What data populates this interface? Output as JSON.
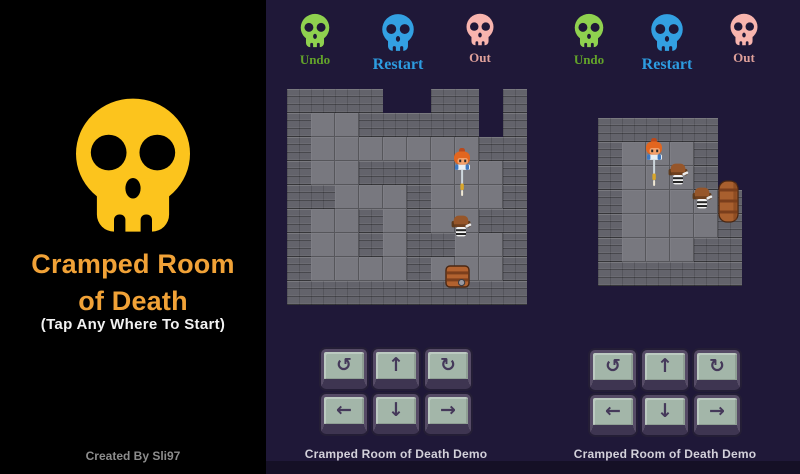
{
  "left_panel": {
    "title_line1": "Cramped Room",
    "title_line2": "of Death",
    "subtitle": "(Tap Any Where To Start)",
    "credit": "Created By Sli97",
    "skull_color": "#fcc41d",
    "skull_hole_color": "#000000",
    "bg_color": "#000000",
    "title_color": "#f1a237"
  },
  "gallery": {
    "bg_color": "#1f1838",
    "wall_color": "#63636b",
    "floor_color": "#78787f"
  },
  "controls": [
    {
      "name": "turn-left-key",
      "glyph": "↺"
    },
    {
      "name": "up-key",
      "glyph": "↑"
    },
    {
      "name": "turn-right-key",
      "glyph": "↻"
    },
    {
      "name": "left-key",
      "glyph": "←"
    },
    {
      "name": "down-key",
      "glyph": "↓"
    },
    {
      "name": "right-key",
      "glyph": "→"
    }
  ],
  "demos": [
    {
      "caption": "Cramped Room of Death Demo",
      "buttons": [
        {
          "name": "undo",
          "label": "Undo",
          "skull_color": "#8fd14f",
          "label_color": "#63a32a",
          "size": 38,
          "label_size": 13
        },
        {
          "name": "restart",
          "label": "Restart",
          "skull_color": "#33a0e2",
          "label_color": "#2d9ce0",
          "size": 42,
          "label_size": 16
        },
        {
          "name": "out",
          "label": "Out",
          "skull_color": "#f8b4ae",
          "label_color": "#dfa09a",
          "size": 36,
          "label_size": 13
        }
      ],
      "map": {
        "tile": 24,
        "rows": [
          "WWWW..WW.W",
          "WFFWWWWW.W",
          "WFFFFFFFWW",
          "WFFWWWFFFW",
          "WWFFFWFFFW",
          "WFFWFWFFWW",
          "WFFWFWWFFW",
          "WFFFFWFFFW",
          "WWWWWWWWWW"
        ],
        "entities": [
          {
            "type": "player",
            "col": 6.8,
            "row": 2.45
          },
          {
            "type": "enemy",
            "col": 6.75,
            "row": 5.2
          },
          {
            "type": "chest",
            "col": 6.6,
            "row": 7.35
          }
        ]
      }
    },
    {
      "caption": "Cramped Room of Death Demo",
      "buttons": [
        {
          "name": "undo",
          "label": "Undo",
          "skull_color": "#8fd14f",
          "label_color": "#63a32a",
          "size": 38,
          "label_size": 13
        },
        {
          "name": "restart",
          "label": "Restart",
          "skull_color": "#33a0e2",
          "label_color": "#2d9ce0",
          "size": 42,
          "label_size": 16
        },
        {
          "name": "out",
          "label": "Out",
          "skull_color": "#f8b4ae",
          "label_color": "#dfa09a",
          "size": 36,
          "label_size": 13
        }
      ],
      "map": {
        "tile": 24,
        "rows": [
          "WWWWW.",
          "WFFFW.",
          "WFFFW.",
          "WFFFFW",
          "WFFFFW",
          "WFFFWW",
          "WWWWWW"
        ],
        "entities": [
          {
            "type": "player",
            "col": 1.85,
            "row": 0.85
          },
          {
            "type": "enemy",
            "col": 2.85,
            "row": 1.85
          },
          {
            "type": "enemy",
            "col": 3.85,
            "row": 2.85
          },
          {
            "type": "barrel",
            "col": 4.92,
            "row": 2.6
          }
        ]
      }
    }
  ]
}
